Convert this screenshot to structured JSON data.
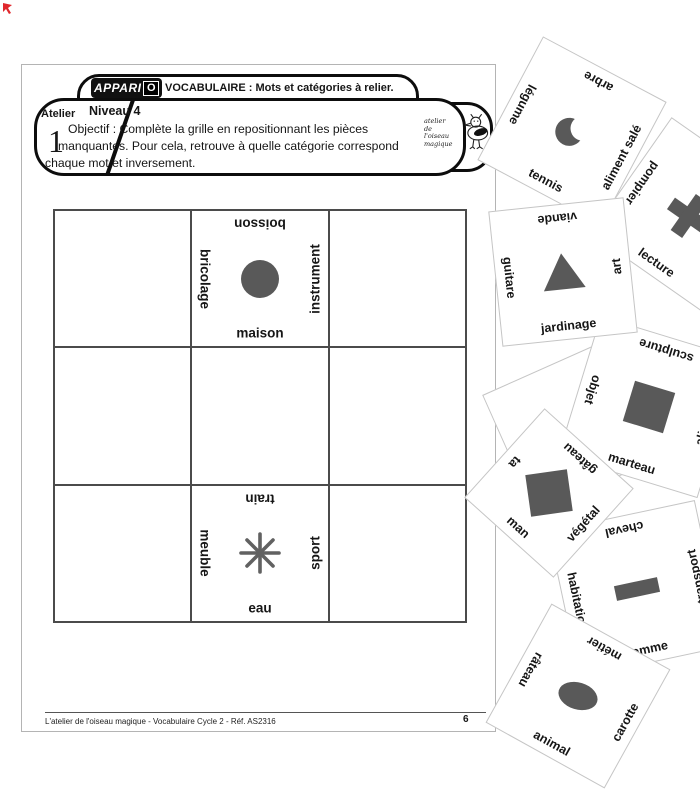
{
  "colors": {
    "shape_gray": "#595959",
    "card_border": "#c5c5c5",
    "grid_line": "#4b4b4b",
    "page_border": "#b4b4b4",
    "accent_red": "#e0282d"
  },
  "header": {
    "brand": {
      "logo_text": "APPARI",
      "logo_badge": "O"
    },
    "title": "VOCABULAIRE : Mots et catégories à relier.",
    "atelier_label": "Atelier",
    "atelier_number": "1",
    "level": "Niveau 4",
    "objective_lines": [
      "Objectif : Complète la grille en repositionnant les pièces",
      "manquantes. Pour cela, retrouve à quelle catégorie correspond",
      "chaque mot et inversement."
    ],
    "publisher_mark": {
      "line1": "atelier",
      "line2": "de",
      "line3": "l'oiseau",
      "line4": "magique"
    }
  },
  "grid": {
    "pieces": [
      {
        "top": "boisson",
        "left": "bricolage",
        "right": "instrument",
        "bottom": "maison",
        "shape": "circle"
      },
      {
        "top": "train",
        "left": "meuble",
        "right": "sport",
        "bottom": "eau",
        "shape": "asterisk"
      }
    ]
  },
  "cards": [
    {
      "top": "arbre",
      "left": "légume",
      "right": "aliment salé",
      "bottom": "tennis",
      "shape": "crescent"
    },
    {
      "top": "viande",
      "left": "guitare",
      "right": "art",
      "bottom": "jardinage",
      "shape": "triangle"
    },
    {
      "top": "pompier",
      "left": "lecture",
      "right": "",
      "bottom": "",
      "shape": "cross"
    },
    {
      "top": "sculpture",
      "left": "objet",
      "right": "aliment",
      "bottom": "marteau",
      "shape": "square"
    },
    {
      "top": "gâteau",
      "left": "ta",
      "right": "végétal",
      "bottom": "man",
      "shape": "square"
    },
    {
      "top": "métier",
      "left": "râteau",
      "right": "carotte",
      "bottom": "animal",
      "shape": "ellipse"
    },
    {
      "top": "cheval",
      "left": "habitation",
      "right": "transport",
      "bottom": "omme",
      "shape": "rectangle"
    }
  ],
  "footer": {
    "caption": "L'atelier de l'oiseau magique - Vocabulaire Cycle 2 - Réf. AS2316",
    "page_number": "6"
  }
}
